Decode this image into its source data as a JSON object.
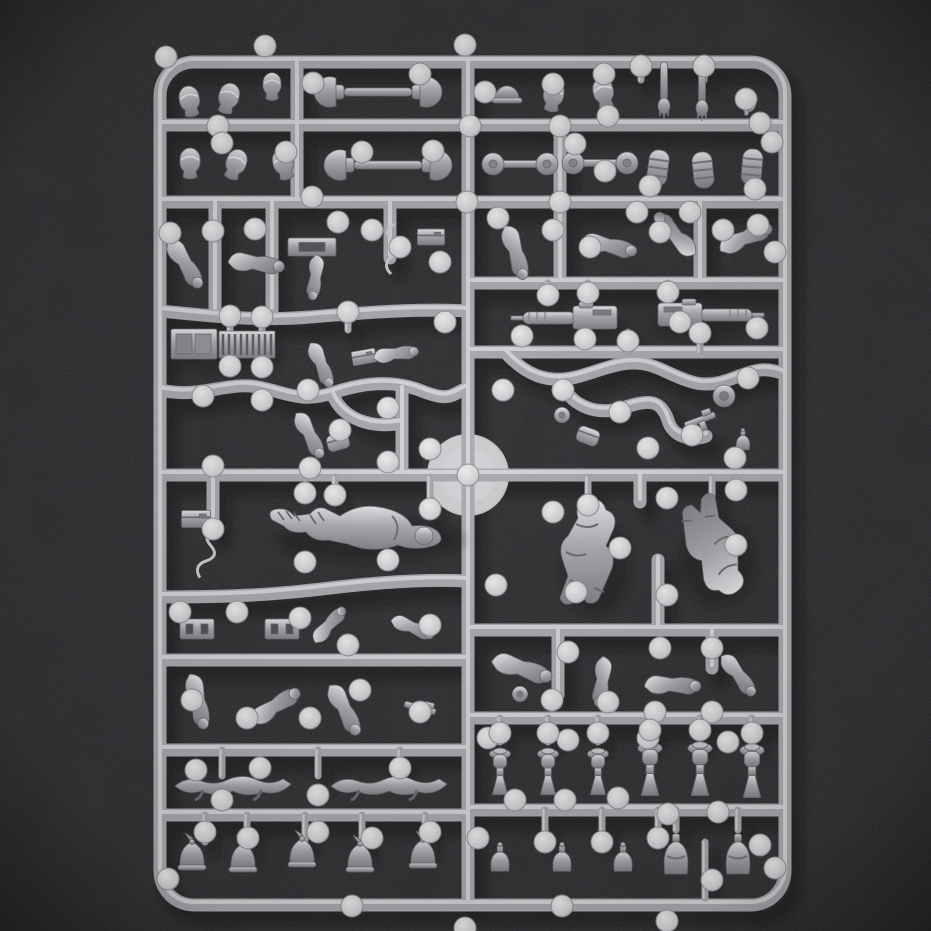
{
  "scene": {
    "type": "photograph",
    "subject": "plastic model kit sprue",
    "description": "Overhead photograph of a silver-grey injection-moulded plastic sprue holding unassembled miniature soldier parts (helmets, heads, arms, machine guns, torsos, canteens) on a dark grey foam background",
    "orientation": "portrait",
    "text_visible": "none"
  },
  "palette": {
    "background": "#232426",
    "foam_mottle": "#0c0d0e",
    "sprue_mid": "#a9aaae",
    "sprue_highlight": "#d8d9dc",
    "sprue_edge": "#7c7d81",
    "part_light": "#e3e4e6",
    "part_dark": "#808185",
    "gate_nub": "#d6d7da",
    "moulding_disc": "#e2e4e6",
    "cast_shadow": "#0a0b0c"
  },
  "sprue": {
    "frame_style": "rounded rectangle with internal runner bars",
    "left_half_rows": 9,
    "right_half_rows": 9,
    "center_disc": "translucent circular moulding boss at runner crossing",
    "gate_nub_count": 145
  },
  "parts_inventory": [
    {
      "name": "paired helmets on connector bars",
      "count": 4
    },
    {
      "name": "separate heads and helmets",
      "count": 10
    },
    {
      "name": "spiked helmets (pickelhaube)",
      "count": 5
    },
    {
      "name": "capped head busts on stands",
      "count": 6
    },
    {
      "name": "rolled blankets / bedrolls",
      "count": 3
    },
    {
      "name": "maxim-style machine guns",
      "count": 2
    },
    {
      "name": "ammunition crate with cartridge rows",
      "count": 1
    },
    {
      "name": "prone machine-gunner body",
      "count": 1
    },
    {
      "name": "running torsos with legs",
      "count": 2
    },
    {
      "name": "arms with weapons and tools",
      "count": 19
    },
    {
      "name": "linked arm pairs",
      "count": 2
    },
    {
      "name": "belt buckles",
      "count": 2
    },
    {
      "name": "canteens and water flasks",
      "count": 6
    },
    {
      "name": "small equipment (plates, boxes, wire, pouches, drums, pistols, straps)",
      "count": 14
    }
  ]
}
